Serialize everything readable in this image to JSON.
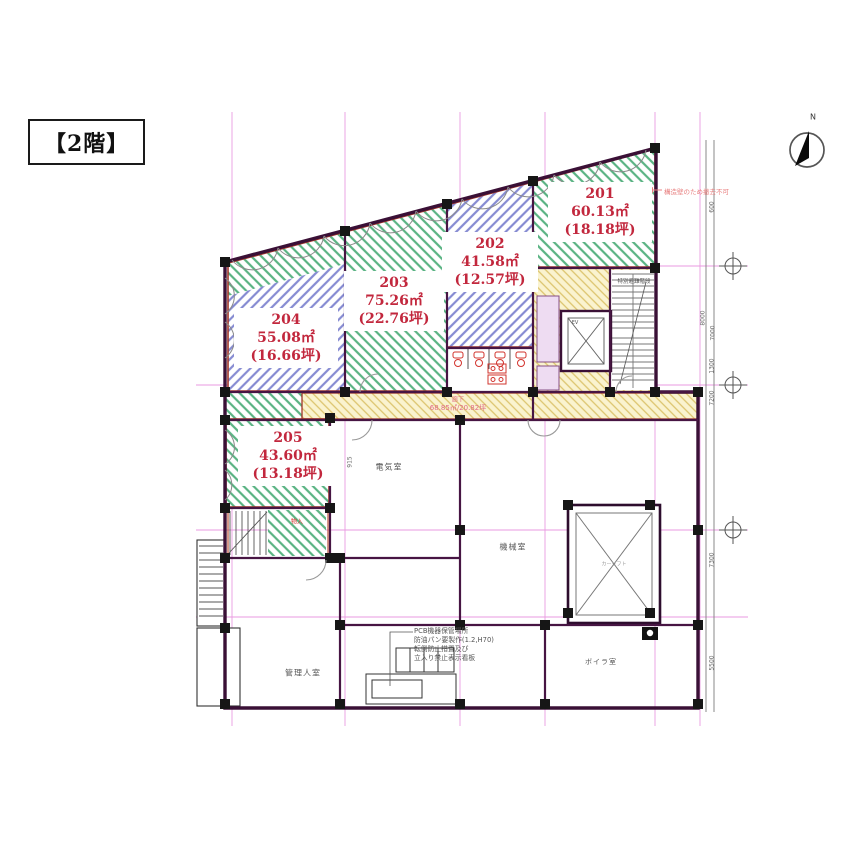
{
  "floor_tag": "【2階】",
  "compass": {
    "north": "N"
  },
  "units": [
    {
      "no": "201",
      "area_m2": "60.13㎡",
      "area_tsubo": "(18.18坪)"
    },
    {
      "no": "202",
      "area_m2": "41.58㎡",
      "area_tsubo": "(12.57坪)"
    },
    {
      "no": "203",
      "area_m2": "75.26㎡",
      "area_tsubo": "(22.76坪)"
    },
    {
      "no": "204",
      "area_m2": "55.08㎡",
      "area_tsubo": "(16.66坪)"
    },
    {
      "no": "205",
      "area_m2": "43.60㎡",
      "area_tsubo": "(13.18坪)"
    }
  ],
  "corridor": {
    "name": "廊下",
    "area": "68.85㎡/20.82坪"
  },
  "rooms": {
    "electrical": "電気室",
    "machine": "機械室",
    "caretaker": "管理人室",
    "boiler": "ボイラ室",
    "escape_stair": "特別避難階段",
    "elevator": "EV",
    "storage": "物入",
    "car_lift": "カーリフト"
  },
  "notes": {
    "pcb_lines": [
      "PCB機器保管場所",
      "防油パン要製作(1.2,H70)",
      "転倒防止措置及び",
      "立入り禁止表示看板"
    ],
    "structure_wall": "構造壁のため撤去不可"
  },
  "dims": {
    "right": [
      "600",
      "8000",
      "7000",
      "1300",
      "7200",
      "7300",
      "5500"
    ],
    "left": [
      "915"
    ]
  },
  "colors": {
    "hatch_green": "#5ab383",
    "hatch_blue": "#868bd2",
    "corridor_bg": "#faf3cf",
    "corridor_stripe": "#dcc46e",
    "unit_text": "#c2273d",
    "unit_border": "#a0352b",
    "wall": "#3a1036",
    "grid": "#e070d4"
  }
}
